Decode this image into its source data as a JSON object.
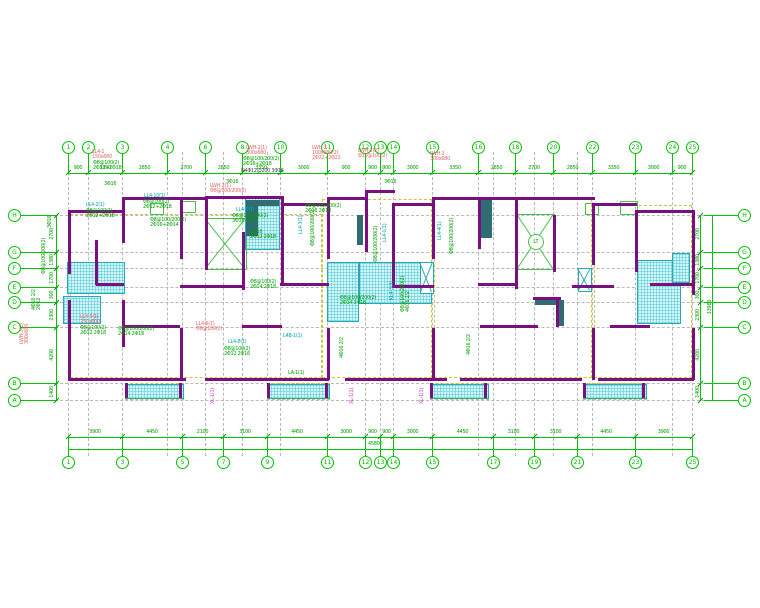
{
  "drawing": {
    "type": "structural-floor-plan",
    "total_width_dim": "45800",
    "total_height_dim": "13980",
    "elevator_label": "LT"
  },
  "colors": {
    "grid_green": "#00c400",
    "dim_text": "#00a000",
    "wall_purple": "#7a1080",
    "shear_teal": "#2e6e72",
    "hatch_cyan": "#2aa8b8",
    "yellow_dash": "#cfc340",
    "label_red": "#e06868",
    "label_green": "#00a000",
    "label_cyan": "#00aaaa",
    "label_magenta": "#c040c0",
    "label_black": "#444444"
  },
  "axes_top": [
    [
      "1",
      68
    ],
    [
      "2",
      88
    ],
    [
      "3",
      122
    ],
    [
      "4",
      167
    ],
    [
      "6",
      205
    ],
    [
      "8",
      242
    ],
    [
      "10",
      280
    ],
    [
      "11",
      327
    ],
    [
      "12",
      365
    ],
    [
      "13",
      380
    ],
    [
      "14",
      393
    ],
    [
      "15",
      432
    ],
    [
      "16",
      478
    ],
    [
      "18",
      515
    ],
    [
      "20",
      553
    ],
    [
      "22",
      592
    ],
    [
      "23",
      635
    ],
    [
      "24",
      672
    ],
    [
      "25",
      692
    ]
  ],
  "axes_bottom": [
    [
      "1",
      68
    ],
    [
      "3",
      122
    ],
    [
      "5",
      182
    ],
    [
      "7",
      223
    ],
    [
      "9",
      267
    ],
    [
      "11",
      327
    ],
    [
      "12",
      365
    ],
    [
      "13",
      380
    ],
    [
      "14",
      393
    ],
    [
      "15",
      432
    ],
    [
      "17",
      493
    ],
    [
      "19",
      534
    ],
    [
      "21",
      577
    ],
    [
      "23",
      635
    ],
    [
      "25",
      692
    ]
  ],
  "axes_letters": [
    [
      "H",
      215
    ],
    [
      "G",
      252
    ],
    [
      "F",
      268
    ],
    [
      "E",
      287
    ],
    [
      "D",
      302
    ],
    [
      "C",
      327
    ],
    [
      "B",
      383
    ],
    [
      "A",
      400
    ]
  ],
  "dims_top": [
    "900",
    "3350",
    "2850",
    "2700",
    "2850",
    "3350",
    "3000",
    "900",
    "900",
    "900",
    "3000",
    "3350",
    "2850",
    "2700",
    "2850",
    "3350",
    "3000",
    "900"
  ],
  "dims_bottom": [
    "3900",
    "4450",
    "2100",
    "3100",
    "4450",
    "3000",
    "900",
    "900",
    "3000",
    "4450",
    "3100",
    "3100",
    "4450",
    "3900"
  ],
  "dims_right": [
    "2700",
    "1380",
    "1700",
    "300",
    "2300",
    "4200",
    "1400"
  ],
  "dims_left": [
    "2700",
    "1380",
    "1700",
    "300",
    "2300",
    "4200",
    "1400"
  ],
  "totals": {
    "bottom": "45800",
    "right": "13980"
  },
  "grey_verticals": [
    68,
    88,
    122,
    167,
    182,
    205,
    223,
    242,
    267,
    280,
    327,
    365,
    380,
    393,
    432,
    478,
    493,
    515,
    534,
    553,
    577,
    592,
    635,
    672,
    692
  ],
  "walls": [
    [
      68,
      210,
      56,
      3
    ],
    [
      122,
      197,
      86,
      3
    ],
    [
      205,
      196,
      78,
      3
    ],
    [
      281,
      203,
      48,
      3
    ],
    [
      327,
      197,
      40,
      3
    ],
    [
      365,
      190,
      30,
      3
    ],
    [
      393,
      203,
      41,
      3
    ],
    [
      432,
      197,
      85,
      3
    ],
    [
      515,
      197,
      80,
      3
    ],
    [
      592,
      203,
      45,
      3
    ],
    [
      635,
      210,
      59,
      3
    ],
    [
      96,
      283,
      28,
      3
    ],
    [
      180,
      285,
      62,
      3
    ],
    [
      280,
      283,
      49,
      3
    ],
    [
      392,
      285,
      42,
      3
    ],
    [
      478,
      283,
      39,
      3
    ],
    [
      572,
      285,
      42,
      3
    ],
    [
      650,
      283,
      44,
      3
    ],
    [
      122,
      325,
      58,
      3
    ],
    [
      242,
      325,
      40,
      3
    ],
    [
      480,
      325,
      58,
      3
    ],
    [
      610,
      325,
      40,
      3
    ],
    [
      533,
      297,
      28,
      3
    ],
    [
      68,
      378,
      118,
      3
    ],
    [
      205,
      378,
      124,
      3
    ],
    [
      345,
      378,
      102,
      3
    ],
    [
      460,
      378,
      122,
      3
    ],
    [
      598,
      378,
      96,
      3
    ],
    [
      68,
      210,
      3,
      64
    ],
    [
      68,
      300,
      3,
      81
    ],
    [
      95,
      240,
      3,
      45
    ],
    [
      122,
      197,
      3,
      46
    ],
    [
      122,
      300,
      3,
      47
    ],
    [
      180,
      197,
      3,
      62
    ],
    [
      180,
      328,
      3,
      52
    ],
    [
      205,
      196,
      3,
      74
    ],
    [
      242,
      232,
      3,
      58
    ],
    [
      281,
      196,
      3,
      90
    ],
    [
      327,
      197,
      3,
      62
    ],
    [
      327,
      328,
      3,
      52
    ],
    [
      365,
      190,
      3,
      62
    ],
    [
      392,
      203,
      3,
      84
    ],
    [
      432,
      197,
      3,
      62
    ],
    [
      432,
      328,
      3,
      52
    ],
    [
      478,
      197,
      3,
      52
    ],
    [
      515,
      197,
      3,
      92
    ],
    [
      553,
      215,
      3,
      57
    ],
    [
      556,
      297,
      3,
      30
    ],
    [
      592,
      203,
      3,
      62
    ],
    [
      592,
      328,
      3,
      52
    ],
    [
      635,
      210,
      3,
      62
    ],
    [
      692,
      210,
      3,
      85
    ],
    [
      692,
      328,
      3,
      52
    ],
    [
      125,
      383,
      3,
      15
    ],
    [
      179,
      383,
      3,
      15
    ],
    [
      267,
      383,
      3,
      15
    ],
    [
      325,
      383,
      3,
      15
    ],
    [
      430,
      383,
      3,
      15
    ],
    [
      484,
      383,
      3,
      15
    ],
    [
      583,
      383,
      3,
      15
    ],
    [
      642,
      383,
      3,
      15
    ]
  ],
  "teal_walls": [
    [
      246,
      200,
      12,
      36
    ],
    [
      253,
      200,
      26,
      6
    ],
    [
      480,
      200,
      12,
      38
    ],
    [
      535,
      297,
      24,
      8
    ],
    [
      357,
      215,
      6,
      30
    ],
    [
      556,
      300,
      8,
      26
    ]
  ],
  "hatches": [
    [
      67,
      262,
      56,
      30
    ],
    [
      63,
      296,
      36,
      26
    ],
    [
      245,
      198,
      33,
      50
    ],
    [
      327,
      262,
      30,
      58
    ],
    [
      359,
      262,
      71,
      40
    ],
    [
      637,
      260,
      42,
      62
    ],
    [
      672,
      253,
      16,
      28
    ],
    [
      420,
      262,
      12,
      30
    ],
    [
      125,
      384,
      57,
      13
    ],
    [
      267,
      384,
      61,
      13
    ],
    [
      430,
      384,
      57,
      13
    ],
    [
      583,
      384,
      62,
      13
    ]
  ],
  "xboxes": [
    [
      578,
      268,
      12,
      22
    ],
    [
      420,
      262,
      12,
      30
    ]
  ],
  "green_rooms": [
    [
      205,
      218,
      40,
      50
    ],
    [
      517,
      214,
      36,
      54
    ]
  ],
  "vent_boxes": [
    [
      150,
      203,
      12,
      10
    ],
    [
      180,
      201,
      14,
      10
    ],
    [
      585,
      203,
      12,
      10
    ],
    [
      620,
      201,
      16,
      12
    ]
  ],
  "yellow_rects": [
    [
      70,
      214,
      250,
      162
    ],
    [
      322,
      199,
      108,
      177
    ],
    [
      434,
      199,
      156,
      177
    ],
    [
      594,
      205,
      96,
      171
    ],
    [
      125,
      383,
      57,
      15
    ],
    [
      267,
      383,
      61,
      15
    ],
    [
      430,
      383,
      57,
      15
    ],
    [
      583,
      383,
      62,
      15
    ]
  ],
  "annotations": [
    {
      "x": 92,
      "y": 150,
      "c": "red",
      "r": 0,
      "t": "LL4-1\n150x680"
    },
    {
      "x": 93,
      "y": 161,
      "c": "grn",
      "r": 0,
      "t": "Φ8@100(2)\n2Φ12+2Φ18"
    },
    {
      "x": 246,
      "y": 146,
      "c": "red",
      "r": 0,
      "t": "LWH-2(1)\n300x680"
    },
    {
      "x": 243,
      "y": 157,
      "c": "grn",
      "r": 0,
      "t": "Φ8@100/200(2)\n2Φ16+2Φ18"
    },
    {
      "x": 241,
      "y": 169,
      "c": "blk",
      "r": 0,
      "t": "N4Φ12@200 3Φ16"
    },
    {
      "x": 312,
      "y": 146,
      "c": "red",
      "r": 0,
      "t": "LWH-3\n100x680(2)\n2Φ22+2Φ22"
    },
    {
      "x": 358,
      "y": 149,
      "c": "red",
      "r": 0,
      "t": "LWH-2(2)\nΦ10@100(2)"
    },
    {
      "x": 430,
      "y": 152,
      "c": "red",
      "r": 0,
      "t": "LWH-1\n300x680"
    },
    {
      "x": 104,
      "y": 182,
      "c": "grn",
      "r": 0,
      "t": "3Φ16"
    },
    {
      "x": 226,
      "y": 180,
      "c": "grn",
      "r": 0,
      "t": "3Φ16"
    },
    {
      "x": 384,
      "y": 180,
      "c": "grn",
      "r": 0,
      "t": "3Φ16"
    },
    {
      "x": 86,
      "y": 203,
      "c": "cyn",
      "r": 0,
      "t": "LL4-2(1)"
    },
    {
      "x": 86,
      "y": 209,
      "c": "grn",
      "r": 0,
      "t": "Φ8@100(2)\n2Φ12+2Φ18"
    },
    {
      "x": 144,
      "y": 194,
      "c": "cyn",
      "r": 0,
      "t": "LL4-10(1)"
    },
    {
      "x": 143,
      "y": 200,
      "c": "grn",
      "r": 0,
      "t": "Φ8@100(2)\n2Φ12+2Φ18"
    },
    {
      "x": 150,
      "y": 218,
      "c": "grn",
      "r": 0,
      "t": "Φ8@100/200(2)\n2Φ16+2Φ14"
    },
    {
      "x": 236,
      "y": 208,
      "c": "cyn",
      "r": 0,
      "t": "LL4-7(1)"
    },
    {
      "x": 232,
      "y": 214,
      "c": "grn",
      "r": 0,
      "t": "Φ8@100/200(2)\n3Φ16 2Φ14"
    },
    {
      "x": 210,
      "y": 184,
      "c": "red",
      "r": 0,
      "t": "LWH-2(1)\nΦ8@100/200(2)"
    },
    {
      "x": 250,
      "y": 230,
      "c": "grn",
      "r": 0,
      "t": "3Φ16\n2Φ12 2Φ18"
    },
    {
      "x": 299,
      "y": 234,
      "c": "cyn",
      "r": 90,
      "t": "LL4-3(1)"
    },
    {
      "x": 311,
      "y": 246,
      "c": "grn",
      "r": 90,
      "t": "Φ8@100/200(2)"
    },
    {
      "x": 383,
      "y": 242,
      "c": "cyn",
      "r": 90,
      "t": "LL4-1(1)"
    },
    {
      "x": 374,
      "y": 262,
      "c": "grn",
      "r": 90,
      "t": "Φ8@100/200(2)"
    },
    {
      "x": 340,
      "y": 296,
      "c": "grn",
      "r": 0,
      "t": "Φ8@100/200(2)\n2Φ14 2Φ18"
    },
    {
      "x": 283,
      "y": 334,
      "c": "cyn",
      "r": 0,
      "t": "L4B-1(1)"
    },
    {
      "x": 288,
      "y": 371,
      "c": "grn",
      "r": 0,
      "t": "LA-1(1)"
    },
    {
      "x": 211,
      "y": 404,
      "c": "mag",
      "r": 90,
      "t": "XL-1(1)"
    },
    {
      "x": 350,
      "y": 404,
      "c": "mag",
      "r": 90,
      "t": "XL-1(1)"
    },
    {
      "x": 420,
      "y": 404,
      "c": "mag",
      "r": 90,
      "t": "XL-1(1)"
    },
    {
      "x": 228,
      "y": 340,
      "c": "cyn",
      "r": 0,
      "t": "LL4-8(1)"
    },
    {
      "x": 224,
      "y": 347,
      "c": "grn",
      "r": 0,
      "t": "Φ8@100(2)\n2Φ12 2Φ16"
    },
    {
      "x": 196,
      "y": 322,
      "c": "red",
      "r": 0,
      "t": "LL4-6(1)\nΦ8@100(2)"
    },
    {
      "x": 118,
      "y": 327,
      "c": "grn",
      "r": 0,
      "t": "Φ8@100/200(2)\n2Φ14 2Φ18"
    },
    {
      "x": 80,
      "y": 315,
      "c": "red",
      "r": 0,
      "t": "LL4-5(1)\n250x600"
    },
    {
      "x": 80,
      "y": 326,
      "c": "grn",
      "r": 0,
      "t": "Φ8@100(2)\n2Φ12 2Φ18"
    },
    {
      "x": 390,
      "y": 300,
      "c": "cyn",
      "r": 90,
      "t": "KL4-3(3)"
    },
    {
      "x": 401,
      "y": 312,
      "c": "grn",
      "r": 90,
      "t": "Φ8@100/200(2)\n4Φ16 2/2"
    },
    {
      "x": 305,
      "y": 204,
      "c": "grn",
      "r": 0,
      "t": "Φ8@100/200(2)\n2Φ16 2Φ18"
    },
    {
      "x": 250,
      "y": 280,
      "c": "grn",
      "r": 0,
      "t": "Φ8@100(2)\n2Φ14 2Φ18"
    },
    {
      "x": 438,
      "y": 240,
      "c": "cyn",
      "r": 90,
      "t": "LL4-4(1)"
    },
    {
      "x": 450,
      "y": 254,
      "c": "grn",
      "r": 90,
      "t": "Φ8@100/200(2)"
    },
    {
      "x": 20,
      "y": 344,
      "c": "red",
      "r": 90,
      "t": "LWH-3(2)\n300x680"
    },
    {
      "x": 32,
      "y": 310,
      "c": "grn",
      "r": 90,
      "t": "4Φ16 2/2\n2Φ12"
    },
    {
      "x": 42,
      "y": 274,
      "c": "grn",
      "r": 90,
      "t": "Φ8@100/200(2)"
    },
    {
      "x": 48,
      "y": 228,
      "c": "grn",
      "r": 90,
      "t": "3Φ16"
    },
    {
      "x": 340,
      "y": 358,
      "c": "grn",
      "r": 90,
      "t": "4Φ16 2/2"
    },
    {
      "x": 467,
      "y": 355,
      "c": "grn",
      "r": 90,
      "t": "4Φ16 2/2"
    },
    {
      "x": 527,
      "y": 246,
      "c": "grn",
      "r": 0,
      "t": ""
    }
  ]
}
